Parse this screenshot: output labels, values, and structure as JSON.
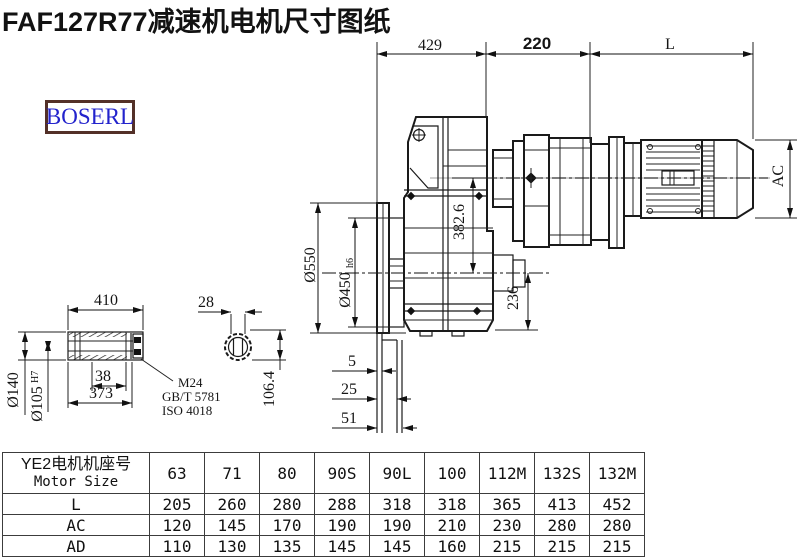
{
  "title": "FAF127R77减速机电机尺寸图纸",
  "logo": "BOSERL",
  "dims": {
    "top429": "429",
    "top220": "220",
    "topL": "L",
    "dia550": "Ø550",
    "dia450": "Ø450",
    "dia450sub": "h6",
    "center382": "382.6",
    "height236": "236",
    "motorAC": "AC",
    "gap5": "5",
    "gap25": "25",
    "gap51": "51",
    "shaft410": "410",
    "bolt28": "28",
    "dia140": "Ø140",
    "dia105": "Ø105",
    "dia105sup": "H7",
    "key38": "38",
    "len373": "373",
    "thread": "M24",
    "std1": "GB/T 5781",
    "std2": "ISO 4018",
    "key1064": "106.4"
  },
  "table": {
    "header_cn": "YE2电机机座号",
    "header_en": "Motor Size",
    "columns": [
      "63",
      "71",
      "80",
      "90S",
      "90L",
      "100",
      "112M",
      "132S",
      "132M"
    ],
    "rows": [
      {
        "label": "L",
        "values": [
          "205",
          "260",
          "280",
          "288",
          "318",
          "318",
          "365",
          "413",
          "452"
        ]
      },
      {
        "label": "AC",
        "values": [
          "120",
          "145",
          "170",
          "190",
          "190",
          "210",
          "230",
          "280",
          "280"
        ]
      },
      {
        "label": "AD",
        "values": [
          "110",
          "130",
          "135",
          "145",
          "145",
          "160",
          "215",
          "215",
          "215"
        ]
      }
    ]
  }
}
